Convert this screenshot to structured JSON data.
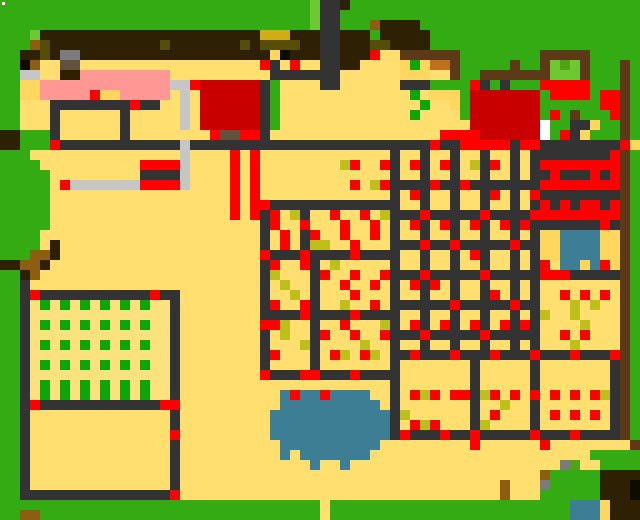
{
  "map": {
    "cols": 64,
    "rows": 52,
    "cell": 10,
    "width": 640,
    "height": 520,
    "background_color": "#34AB12",
    "palette": {
      "G": "#34AB12",
      "g": "#0AA60A",
      "L": "#6EC832",
      "M": "#4FA317",
      "T": "#FFDF70",
      "f": "#FCE27F",
      "P": "#FF9895",
      "D": "#333333",
      "K": "#2E2103",
      "O": "#564D07",
      "B": "#8B5E12",
      "N": "#5C3A17",
      "C": "#C06F1D",
      "y": "#C6C6C6",
      "s": "#7B7B7B",
      "u": "#64513D",
      "R": "#FF0000",
      "r": "#C80000",
      "Y": "#D2AC14",
      "l": "#FFD75E",
      "o": "#BFBF1C",
      "W": "#3E7E95",
      "w": "#FFFFFF",
      "b": "#0E0B00"
    },
    "specks": [
      {
        "x": 2,
        "y": 2,
        "w": 3,
        "h": 3,
        "color": "#FFFFFF"
      }
    ],
    "grid": [
      "GGGGGGGGGGGGGGGGGGGGGGGGGGGGGGGLDDKGGGGGGGGGGGGGGGGGGGGGGGGGGGG",
      "GGGGGGGGGGGGGGGGGGGGGGGGGGGGGGGLDDGGGGGGGGGGGGGGGGGGGGGGGGGGGGG",
      "GGGGGGGGGGGGGGGGGGGGGGGGGGGGGGGLDDGGGBKKKKGGGGGGGGGGGGGGGGGGGGG",
      "GGGLKKKKKKKKKKKKKKKKKKKKKKYYYKKKDDKKKGKKKKKGGGGGGGGGGGGGGGGGGGGG",
      "GGGBOKKKKKKKKKKKOKKKKKKKOKOOOOKKDDKKKOOKKKKGGGGGGGGGGGGGGGGGGGGG",
      "GGKKOKssKKKKKKKKKKKKKKKKKKKlbKKKDDKKKRTTNNNNNNGGGGGGGGNNNNNGGGGG",
      "GGbBTTuuTTTTTTTTTTTTTTTTTTRDTRTTDDKKTTTTlglCCNGGGGGNGGNLMLNGGGNG",
      "GGyyTTKKPPPPPPPPPTTTTTTTTTTDDDDDDDTTTTTTlllTTNGGNNNNNNNLLLNGGGNG",
      "GGllPPPPPPPPPPPPPyyRrrrrrrDGTTTTDDTTTTTTDDDGGGGRDGDGGGRRRRRGGGNG",
      "GGllPPPPPRllPPPPPTyTrrrrrrDGTTTTTTTTTTTTTgTlllGrrrrrrrGRRRRGRRNG",
      "GGTTTDDDDDDDDRDDTTyTrrrrrrDGTTTTTTTTTTTTTTgTTlGrrrrrrrGGGGGGRRNG",
      "GGTTTDTTTTTTDTTTTTyTrrrrrrDGTTTTTTTTTTTTTgTTTTGrrrrrrrGRGNGGGRNG",
      "GGTTTDTTTTTTDTTTTTyTrrrrrrDGTTTTTTTTTTTTTTTTTTTrrrrrrrwGGDDlGGNG",
      "KKGGGDTTTTTTDTTTTTTTTRuuRRDTTTTTTTTTTTTTTTTTRRRRrrrrrrwGRDlGGGNG",
      "KKGGGRDDDDDDDDDDDDyDDDDDDDDDDDDDDDDDDDDDDDDRDDRRRRRDRRDDDDDDDDRl",
      "GGGTTTTTTTTTTTTTTTyTTTTRTRTTTTTTTTTTTTTDTTDTTDTTDTTDTDDDDDDDDRNG",
      "GGGGTTTTTTTTTTRRRRyTTTTRTRTTTTTTTToRTTRDTRDTRDToDRTDTDRRRRRRRRNG",
      "GGGGGTTTTTTTTTDDDDyTTTTRTRTTTTTTTTTTTTTDTTDTTDTTDTTDTDDRDDDRDRNG",
      "GGGGGTRyyyyyyyRRRRyTTTTRTRTTTTTTTTTRToRDDDDRDDRDDDDDDDRRRRRRRRNG",
      "GGGGGTTTTTTTTTTTTTTTTTTRTRTTTTTTTTTTTTTDTRDTTDTTDRTDTRDDDDDDDDNG",
      "GGGGGTTTTTTTTTTTTTTTTTTRTRRDDDDDDDDDDDDDTTDTTDTTDTTDTDRDRDRRDRNG",
      "GGGGGTTTTTTTTTTTTTTTTTTRTRDRToDTTRTTRToDDDRDDDDDRDDDDRRRRRRRRRNG",
      "GGGGGTTTTTTTTTTTTTTTTTTTTTDRTTRTTTRTTRTDTRDTRDTRDTRDRDDDDDDDRDNG",
      "GGGGTTTTTTTTTTTTTTTTTTTTTTDTRTDRTTRTTRTDTTDTTDTTDTTDTDllWWWWllNG",
      "GGGGTKTTTTTTTTTTTTTTTTTTTTDTRTDooTTRTTTDDDRDDRDDDDDRDDllWWWWllNG",
      "GGGBBKTTTTTTTTTTTTTTTTTTTTRDDDRDDDDRDDDDTTDTTDTRDTTDTDllWWWWllNG",
      "KKBBKTTTTTTTTTTTTTTTTTTTTTDRTTRDToTTTTTDTTDTTDTTDTTDTDRTWWlWRlNG",
      "GGKBTTTTTTTTTTTTTTTTTTTTTTDoTTTDRTTRTTRDDDRDDDDDRDDDDDRRRDDDDDNG",
      "GGDTTTTTTTTTTTTTTTTTTTTTTTDToTTDTTRTTRTDTRDRTDTTDTTDTDTTTTTTTTNG",
      "GGDRDDDDDDDDDDDRDDTTTTTTTTDTToTDTTTRTTTDTTDTTDTTDRTDTDTTRTRTRTNG",
      "GGDfgfgfgfgfgfgffDTTTTTTTTDRTTRDTToTTRTDDDDDDRDDDDDRDDTTToToTTNG",
      "GGDffffffffffffffDTTTTTTTTDDDDRDDDDRDDDDTTDTTDTTDTTDTDoTToTTTTNG",
      "GGDfgfgfgfgfgfgffDTTTTTTTTRRoTTDTTRTTToDTRDTRDTRDTRDRDTTTToTTTNG",
      "GGDffffffffffffffDTTTTTTTTDToTTDRTTRTTRDDDRDDDDDRDDDDDTTRTRTTTNG",
      "GGDfgfgfgfgfgfgffDTTTTTTTTDTTToDTTTToTTDTTDTTDTTDTTDTDTTToTTTTNG",
      "GGDffffffffffffffDTTTTTTTTDRTTTDTRoTRoTDDRDDDRDDDRDDDRDDDRDDDRNG",
      "GGDfgfgfgfgfgfgffDTTTTTTTTDTTTTDTTTTTTTDTTTTTTTDTTTTTDTTTTTTTDNG",
      "GGDffffffffffffffDTTTTTTTTRDDDRRDDDRDDDDTTTTTTTDTTTTTDTTTTTTTDNG",
      "GGDfgfgfgfgfgfgffDTTTTTTTTTTTTTTTTTTTTTDTTTTTTTDTTTTTDTTTTTTTDNG",
      "GGDfgfgfgfgfgfgffDTTTTTTTTTTWRWWRWWWWTTDTRoRTRRDoRTRTRTRTRTRoDNG",
      "GGDRDDDDDDDDDDDDRRTTTTTTTTTTWWWWWWWWWWTDTTTTTTTDTToTTDTTTTTTTDNG",
      "GGDTTTTTTTTTTTTTTDTTTTTTTTTWWWWWWWWWWWWDoTTTTTTDTRTTTDTRTRTRTDNG",
      "GGDTTTTTTTTTTTTTTDTTTTTTTTTWWWWWWWWWWWWDTRoRTTTDoTTTTDTTTTTTTDNG",
      "GGDTTTTTTTTTTTTTTRTTTTTTTTTWWWWWWWWWWWWDRDDDRDDRDDDDDRDDDRDDDDNG",
      "GGDTTTTTTTTTTTTTTDTTTTTTTTTTWWWWWWWWWWTTTTTTTTTRTTTTTTRTTTTTTTTNG",
      "GGDTTTTTTTTTTTTTTDTTTTTTTTTTWTWWWWWWWTTTTTTTTTTTTTTTTTTTTTTGGGGG",
      "GGDTTTTTTTTTTTTTTDTTTTTTTTTTTTTWTTWTTTTTTTTTTTTTTTTTTTTTsMTTGGGGL",
      "GGDTTTTTTTTTTTTTTDTTTTTTTTTTTTTTTTTTTTTTTTTTTTTTTTTTTTBGGGGGKKKK",
      "GGDTTTTTTTTTTTTTTDTTTTTTTTTTTTTTTTTTTTTTTTTTTTTTTTBTTTsGGGGGKKKb",
      "GGDDDDDDDDDDDDDDDRTTTTTTTTTTTTTTTTTTTTTTTTTTTTTTTTBTTTGGGGGGKKKb",
      "GGGGGGGGGGGGGGGGGGGGGGGGGGGGGGGGTGGGGGGGGGGGGGGGGGGGGGGGGWWWlKKK",
      "GGBBGGGGGGGGGGGGGGGGGGGGGGGGGGGGTGGGGGGGGGGGGGGGGGGGGGGGGWWWlKKK"
    ],
    "regions": [
      {
        "name": "region-tree-grove-north",
        "x": 40,
        "y": 30,
        "w": 390,
        "h": 35
      },
      {
        "name": "region-watchtower",
        "x": 320,
        "y": 0,
        "w": 20,
        "h": 85
      },
      {
        "name": "region-pink-roof-house",
        "x": 40,
        "y": 70,
        "w": 130,
        "h": 35
      },
      {
        "name": "region-dark-red-building",
        "x": 200,
        "y": 80,
        "w": 60,
        "h": 50
      },
      {
        "name": "region-herb-garden",
        "x": 540,
        "y": 55,
        "w": 55,
        "h": 30
      },
      {
        "name": "region-red-striped-shrine",
        "x": 530,
        "y": 150,
        "w": 90,
        "h": 80
      },
      {
        "name": "region-blue-pool",
        "x": 555,
        "y": 225,
        "w": 50,
        "h": 45
      },
      {
        "name": "region-orchard-plot-grid",
        "x": 390,
        "y": 150,
        "w": 150,
        "h": 210
      },
      {
        "name": "region-left-orchard-plots",
        "x": 260,
        "y": 200,
        "w": 135,
        "h": 180
      },
      {
        "name": "region-crop-field",
        "x": 20,
        "y": 285,
        "w": 155,
        "h": 125
      },
      {
        "name": "region-south-paddock",
        "x": 20,
        "y": 410,
        "w": 155,
        "h": 90
      },
      {
        "name": "region-pond",
        "x": 265,
        "y": 388,
        "w": 125,
        "h": 85
      },
      {
        "name": "region-stone-path",
        "x": 55,
        "y": 155,
        "w": 140,
        "h": 40
      }
    ]
  }
}
